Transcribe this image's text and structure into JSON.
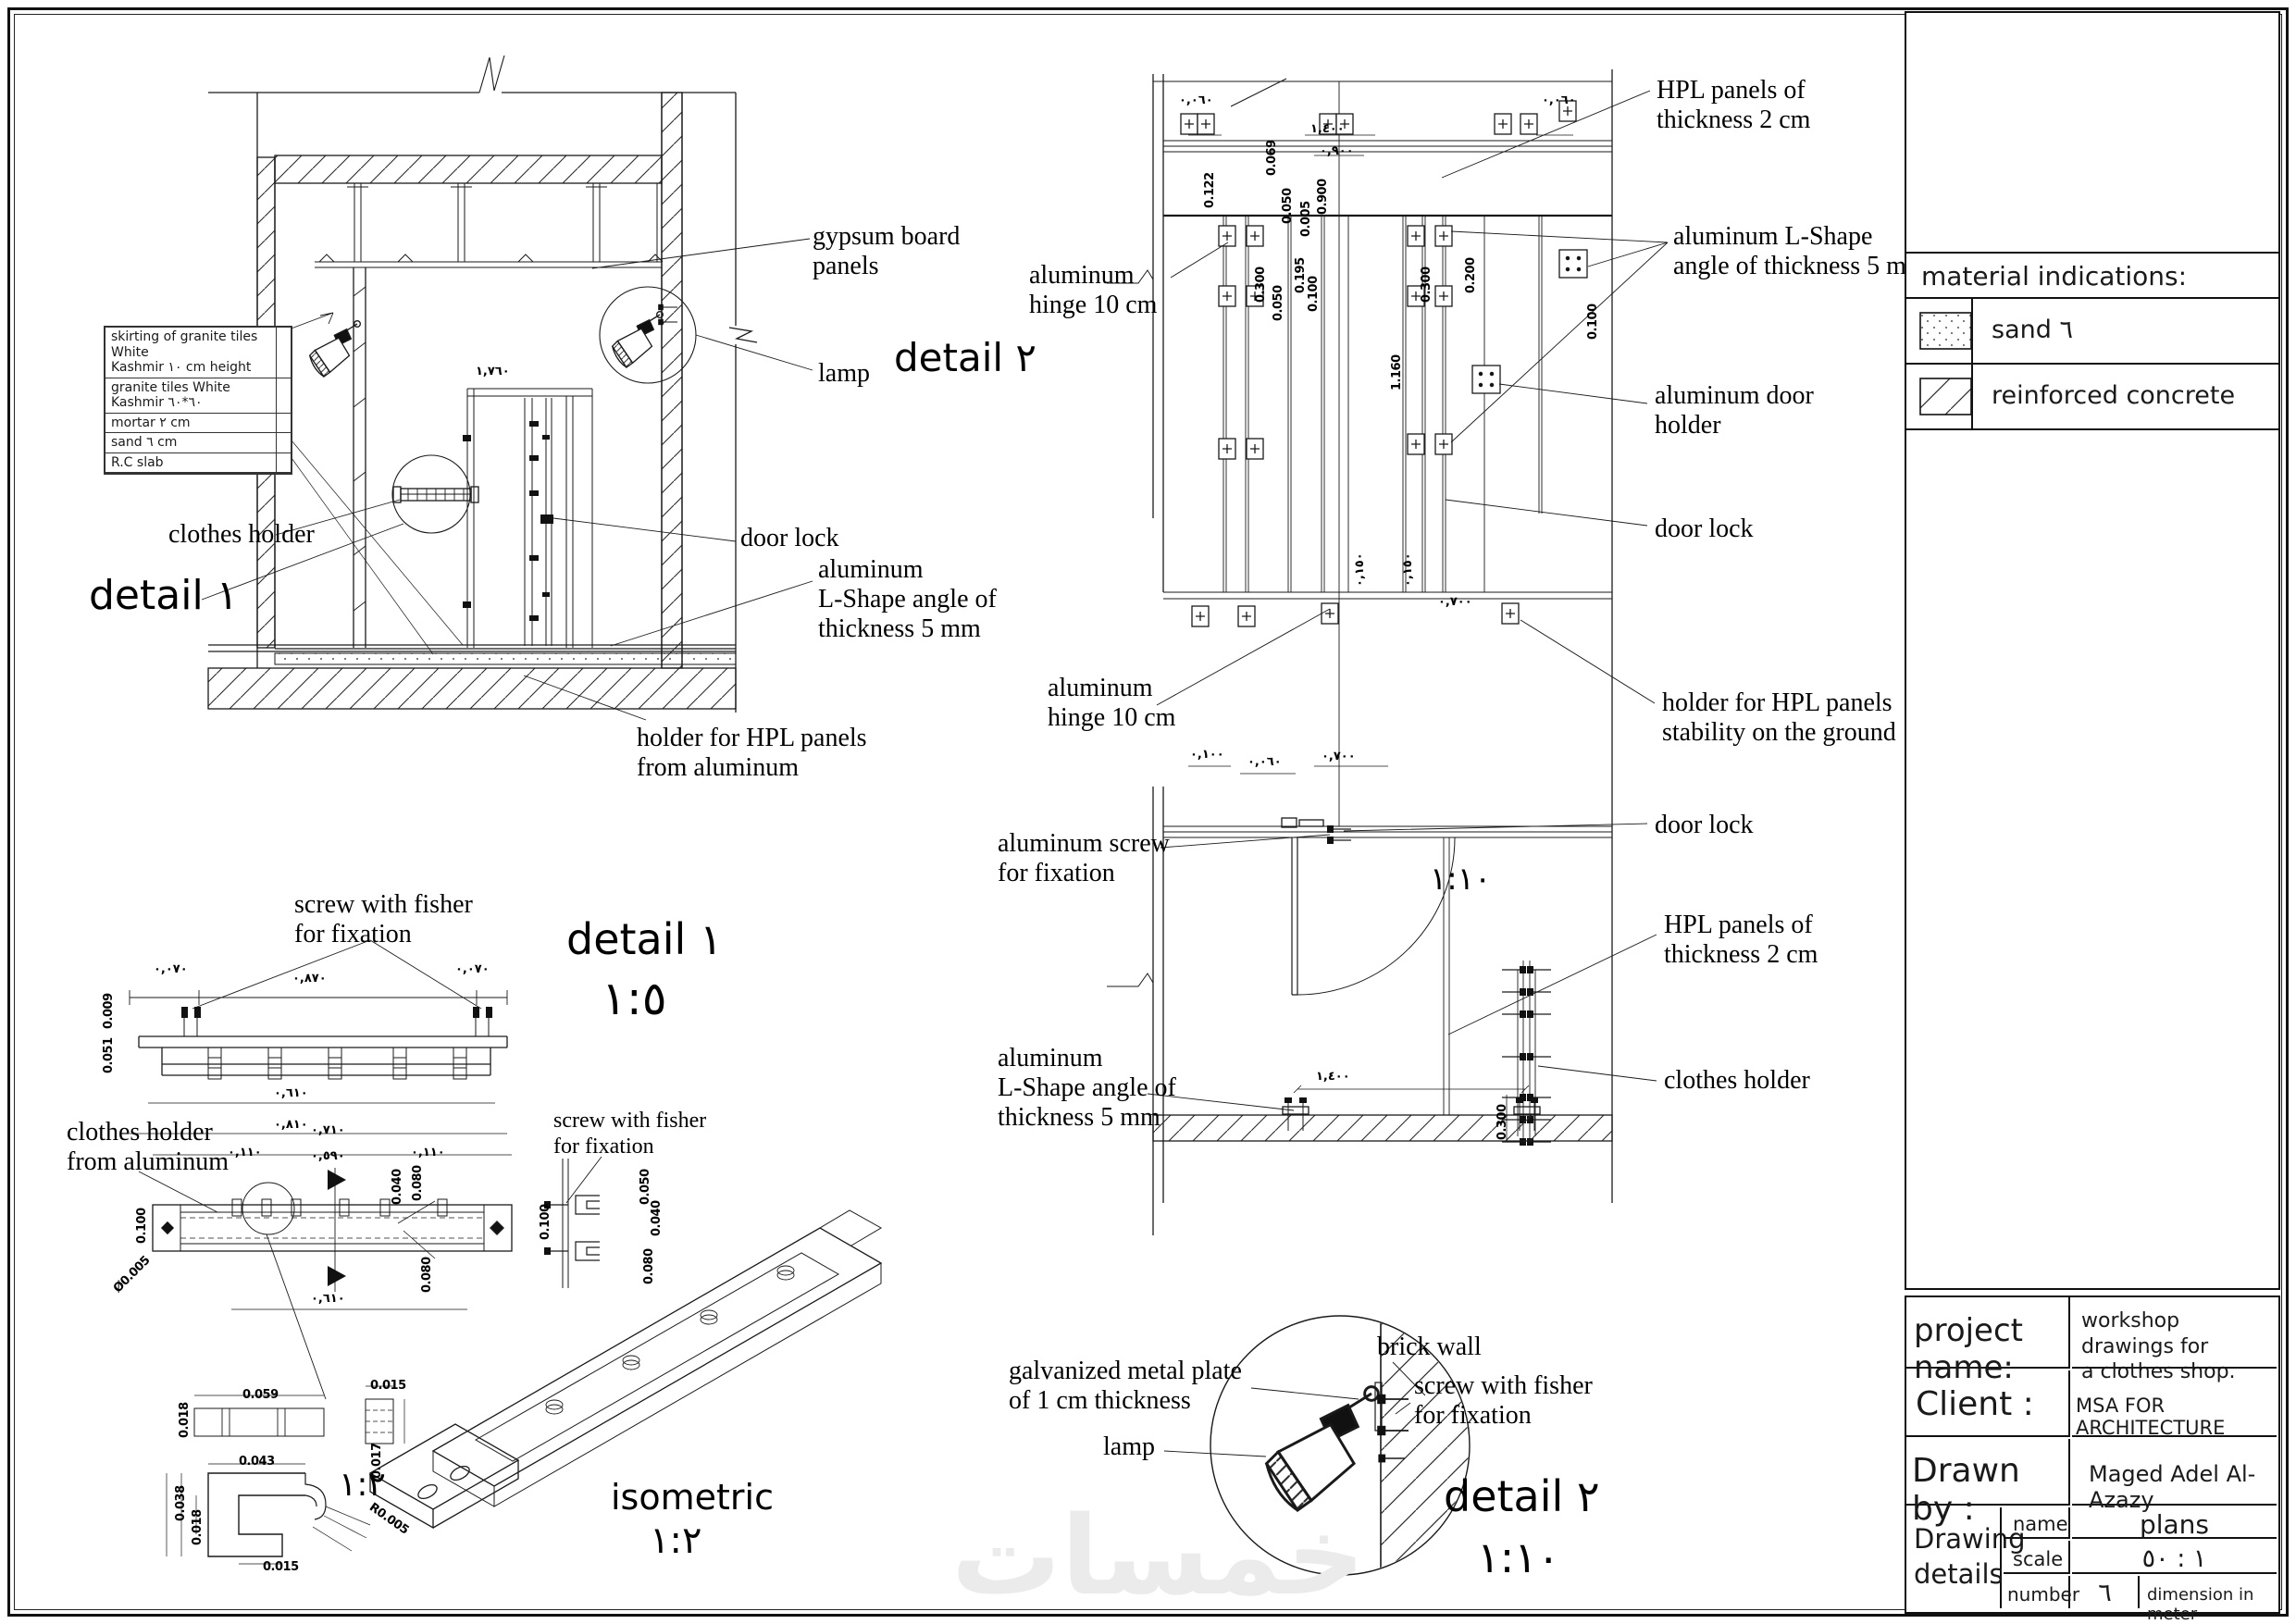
{
  "sheet": {
    "watermark": "خمسات"
  },
  "materials_panel": {
    "title": "material indications:",
    "items": [
      {
        "label": "sand ٦",
        "swatch": "sand-dots"
      },
      {
        "label": "reinforced concrete",
        "swatch": "diagonal-hatch"
      }
    ]
  },
  "title_block": {
    "project_label": "project name:",
    "project_value": "workshop drawings for\na clothes shop.",
    "client_label": "Client :",
    "client_value": "MSA FOR ARCHITECTURE",
    "drawn_label": "Drawn by :",
    "drawn_value": "Maged Adel Al-Azazy",
    "details_label": "Drawing\ndetails",
    "name_label": "name",
    "name_value": "plans",
    "scale_label": "scale",
    "scale_value": "١ : ٥٠",
    "number_label": "number",
    "number_value": "٦",
    "dimension_note": "dimension in meter"
  },
  "layers_table": {
    "rows": [
      "skirting of granite tiles White\nKashmir ١٠ cm height",
      "granite tiles White\nKashmir ٦٠*٦٠",
      "mortar ٢ cm",
      "sand ٦ cm",
      "R.C slab"
    ]
  },
  "labels": {
    "gypsum": "gypsum board\npanels",
    "lamp": "lamp",
    "detail2_ref": "detail ٢",
    "clothes_holder": "clothes holder",
    "detail1_ref": "detail ١",
    "door_lock": "door lock",
    "lshape": "aluminum\nL-Shape angle of\nthickness 5 mm",
    "holder_hpl": "holder for HPL panels\nfrom aluminum",
    "hinge_top": "aluminum\nhinge 10 cm",
    "hpl_top": "HPL panels of\nthickness 2 cm",
    "lshape_right": "aluminum L-Shape\nangle of thickness 5 mm",
    "door_holder": "aluminum door\nholder",
    "door_lock_right": "door lock",
    "hinge_mid": "aluminum\nhinge 10 cm",
    "holder_stability": "holder for HPL panels\nstability on the ground",
    "screw_fixation": "aluminum screw\nfor fixation",
    "door_lock_bottom": "door lock",
    "hpl_bottom": "HPL panels of\nthickness 2 cm",
    "lshape_bottom": "aluminum\nL-Shape angle of\nthickness 5 mm",
    "clothes_holder_right": "clothes holder",
    "screw_fisher_top": "screw with fisher\nfor fixation",
    "clothes_holder_alum": "clothes holder\nfrom aluminum",
    "screw_fisher_mid": "screw with fisher\nfor fixation",
    "galvanized": "galvanized metal plate\nof 1 cm thickness",
    "brick_wall": "brick wall",
    "screw_fisher_d2": "screw with fisher\nfor fixation",
    "lamp_d2": "lamp"
  },
  "scale_texts": {
    "detail1_title": "detail ١",
    "detail1_scale": "١:٥",
    "detail2_title": "detail ٢",
    "detail2_scale": "١:١٠",
    "iso_title": "isometric",
    "iso_scale": "١:٢",
    "parts_scale": "١:٢",
    "plan_scale": "١:١٠"
  },
  "dims": [
    "0.122",
    "0.069",
    "0.050",
    "0.005",
    "0.900",
    "0.300",
    "0.195",
    "0.100",
    "0.050",
    "1.160",
    "0.300",
    "0.200",
    "0.100",
    "١,٤٠٠",
    "٠,٩٠٠",
    "٠,٠٦٠",
    "٠,٠٦٠",
    "٠,١٥٠",
    "٠,١٥٠",
    "٠,٧٠٠",
    "٠,١٠٠",
    "٠,٧٠٠",
    "٠,٠٦٠",
    "١,٤٠٠",
    "0.300",
    "٠,٠٧٠",
    "٠,٨٧٠",
    "٠,٠٧٠",
    "٠,٦١٠",
    "٠,٨١٠",
    "0.009",
    "0.051",
    "٠,٧١٠",
    "٠,٥٩٠",
    "٠,١١٠",
    "٠,١١٠",
    "0.100",
    "0.040",
    "0.080",
    "0.080",
    "٠,٦١٠",
    "0.100",
    "0.050",
    "0.040",
    "0.080",
    "0.015",
    "0.059",
    "0.018",
    "0.043",
    "0.017",
    "0.038",
    "0.018",
    "0.015",
    "R0.005",
    "١,٧٦٠",
    "Ø0.005"
  ]
}
